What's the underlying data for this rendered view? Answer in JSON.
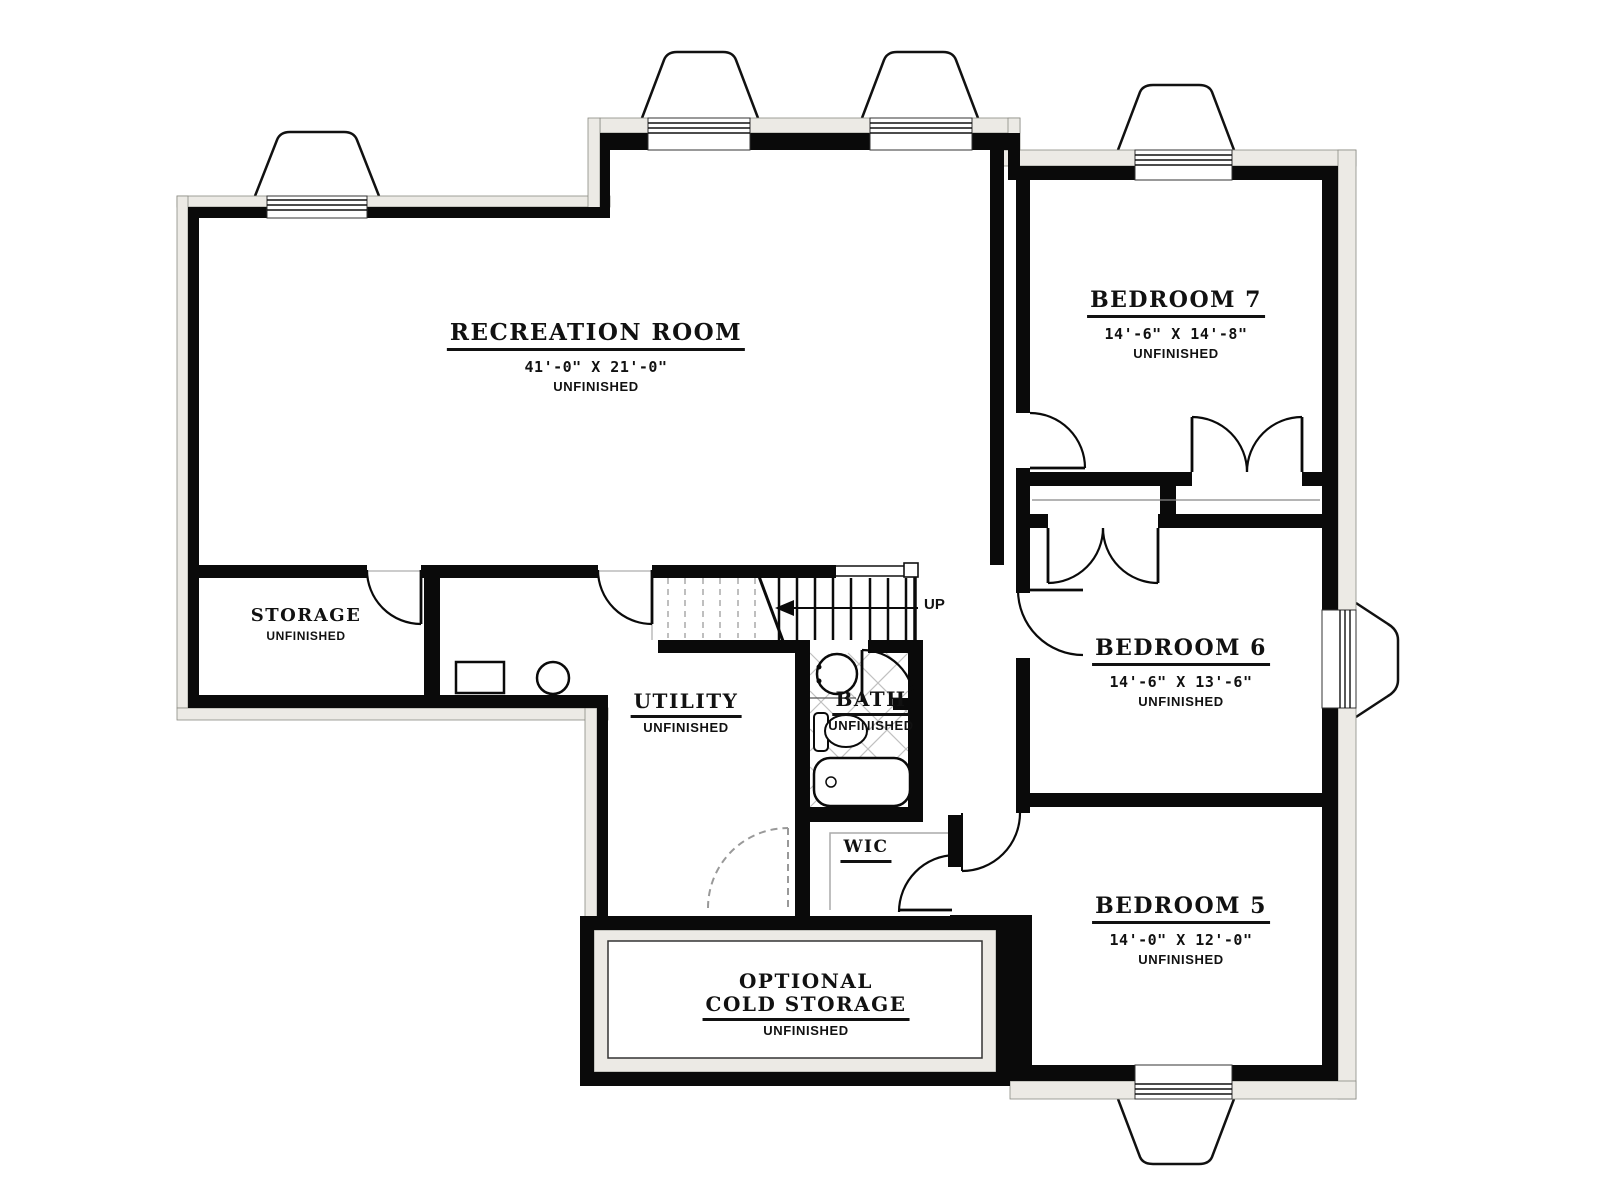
{
  "rooms": {
    "recreation": {
      "name": "RECREATION ROOM",
      "dims": "41'-0\" X 21'-0\"",
      "status": "UNFINISHED"
    },
    "bedroom7": {
      "name": "BEDROOM 7",
      "dims": "14'-6\" X 14'-8\"",
      "status": "UNFINISHED"
    },
    "bedroom6": {
      "name": "BEDROOM 6",
      "dims": "14'-6\" X 13'-6\"",
      "status": "UNFINISHED"
    },
    "bedroom5": {
      "name": "BEDROOM 5",
      "dims": "14'-0\" X 12'-0\"",
      "status": "UNFINISHED"
    },
    "storage": {
      "name": "STORAGE",
      "status": "UNFINISHED"
    },
    "utility": {
      "name": "UTILITY",
      "status": "UNFINISHED"
    },
    "bath": {
      "name": "BATH",
      "status": "UNFINISHED"
    },
    "wic": {
      "name": "WIC"
    },
    "cold_storage": {
      "line1": "OPTIONAL",
      "line2": "COLD STORAGE",
      "status": "UNFINISHED"
    }
  },
  "stairs": {
    "direction_label": "UP"
  },
  "colors": {
    "wall": "#0a0a0a",
    "concrete": "#eceae5",
    "tile_line": "#c0c0c0",
    "background": "#ffffff"
  }
}
